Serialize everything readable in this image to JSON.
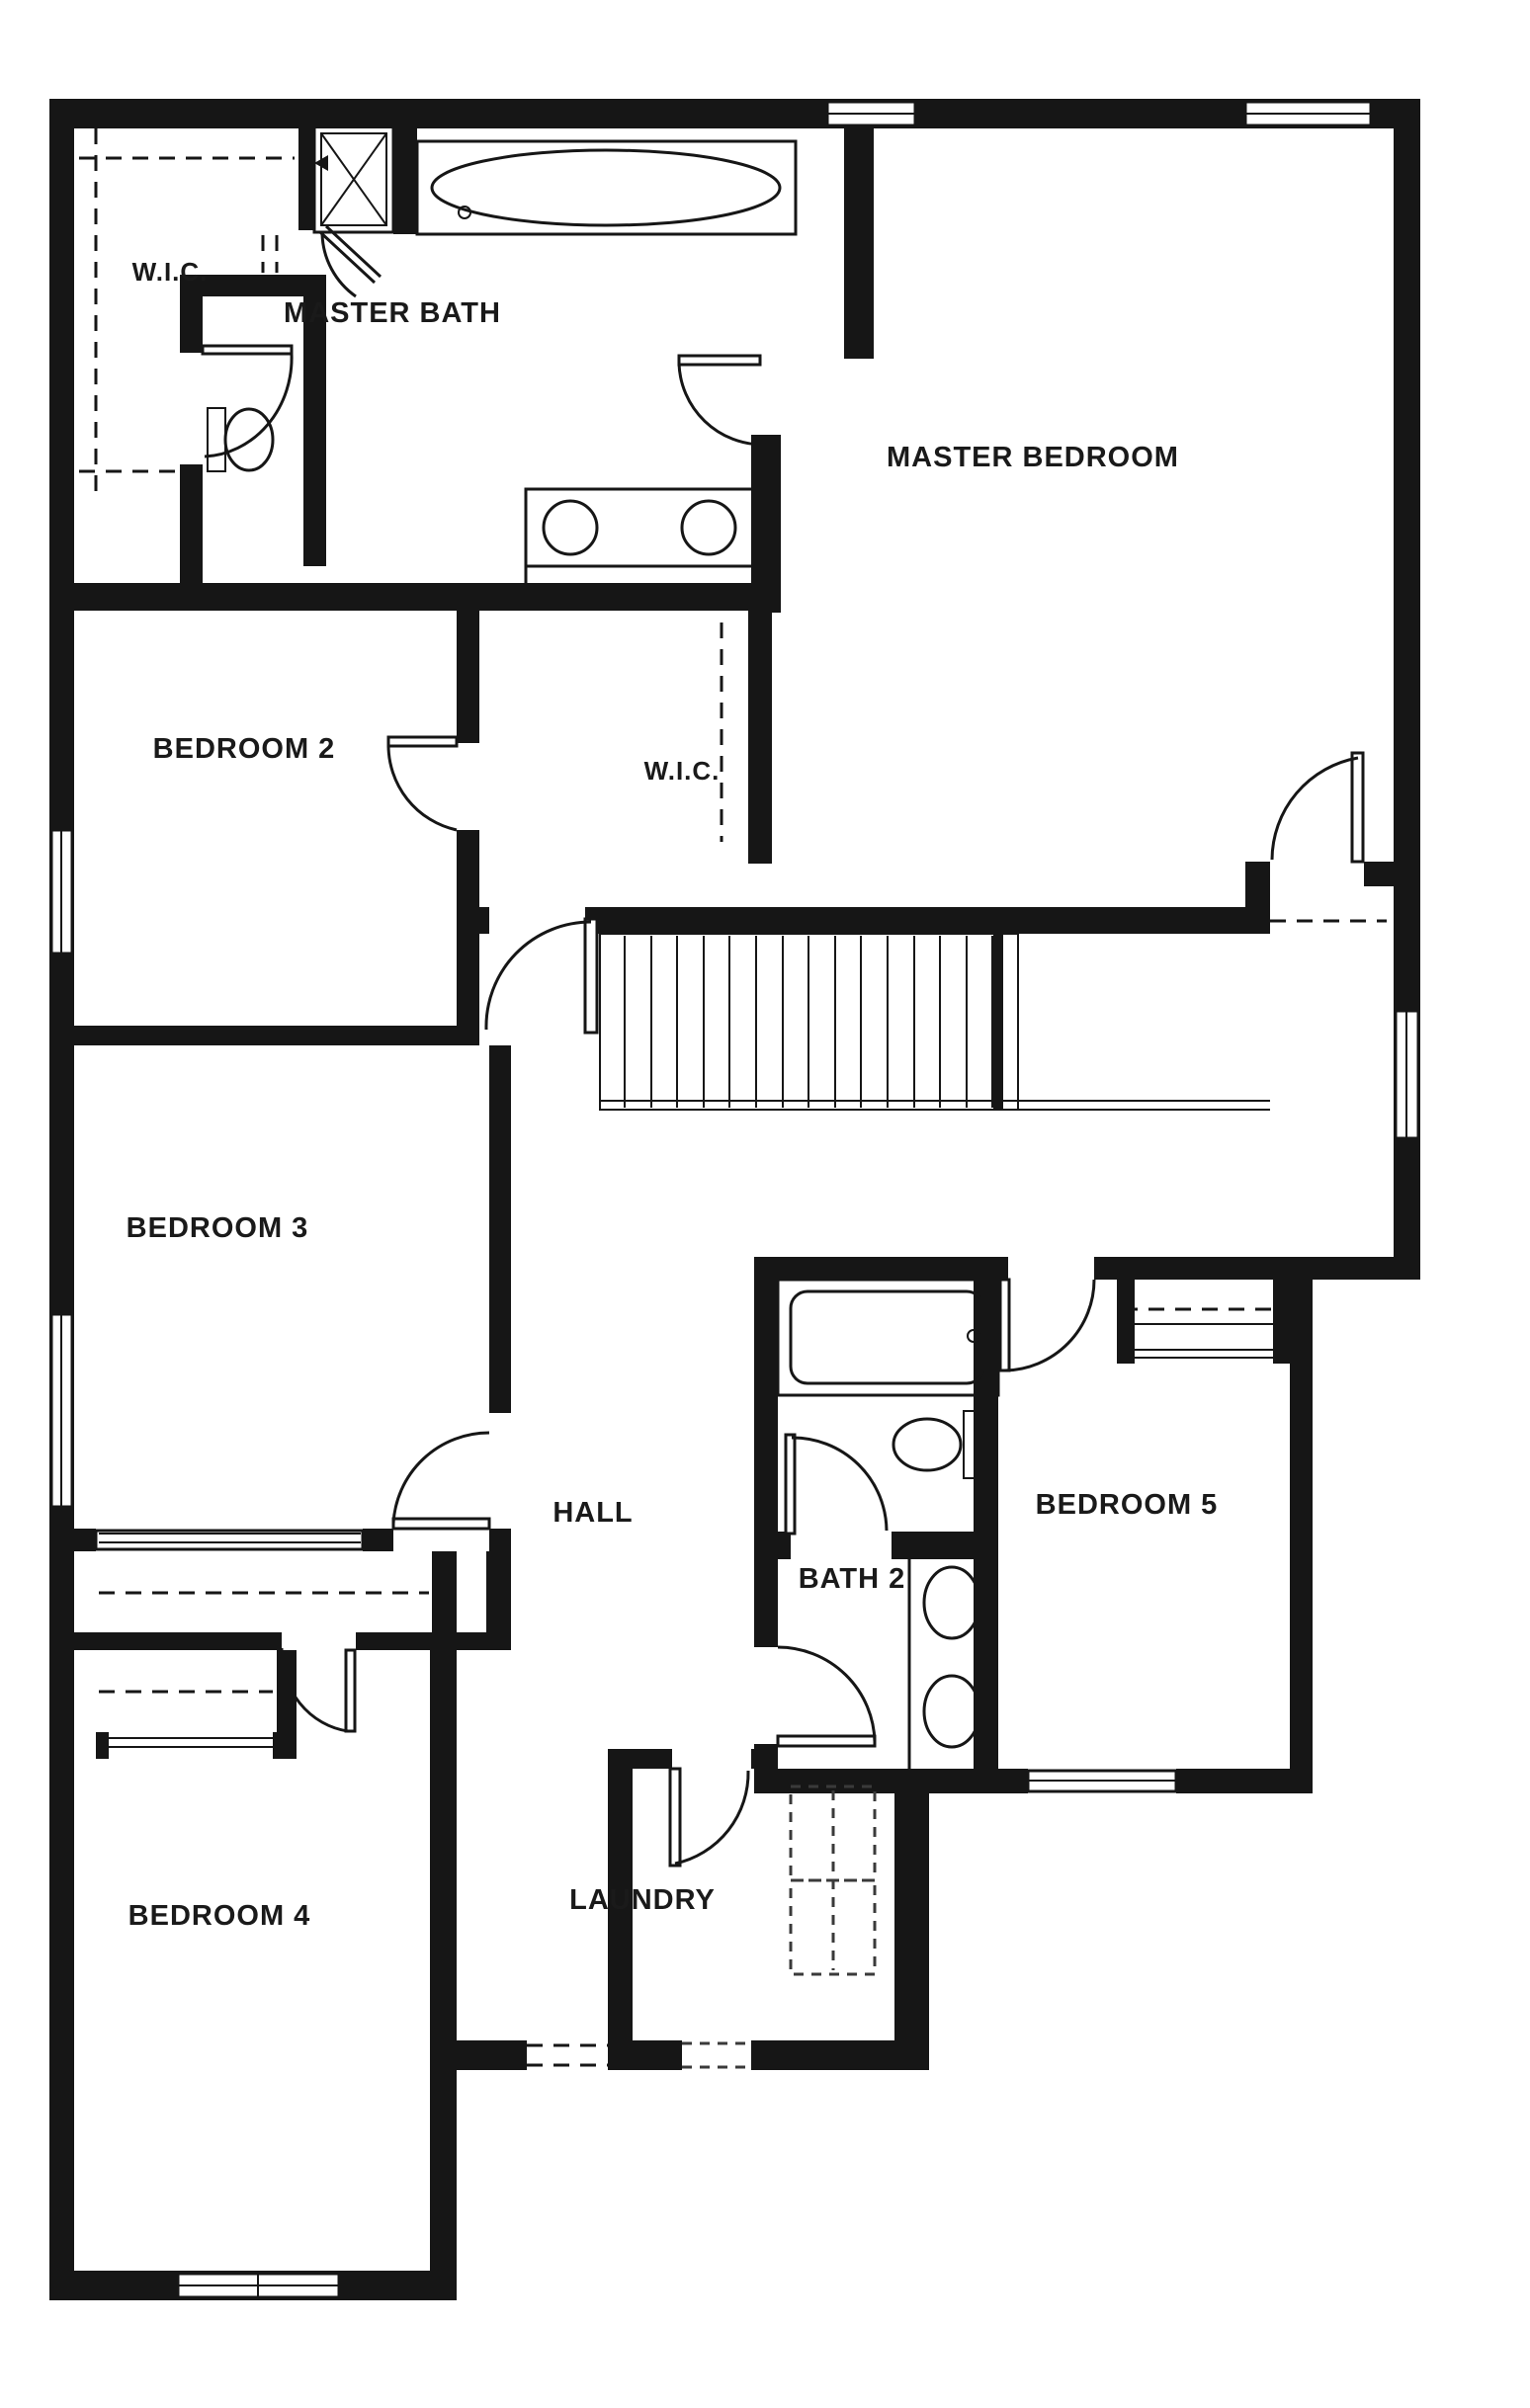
{
  "floor_plan": {
    "background_color": "#ffffff",
    "wall_color": "#161616",
    "text_color": "#1a1a1a",
    "rooms": [
      {
        "name": "wic-master",
        "label": "W.I.C."
      },
      {
        "name": "master-bath",
        "label": "MASTER BATH"
      },
      {
        "name": "master-bedroom",
        "label": "MASTER BEDROOM"
      },
      {
        "name": "bedroom-2",
        "label": "BEDROOM 2"
      },
      {
        "name": "wic-2",
        "label": "W.I.C."
      },
      {
        "name": "bedroom-3",
        "label": "BEDROOM 3"
      },
      {
        "name": "hall",
        "label": "HALL"
      },
      {
        "name": "bath-2",
        "label": "BATH 2"
      },
      {
        "name": "bedroom-5",
        "label": "BEDROOM 5"
      },
      {
        "name": "bedroom-4",
        "label": "BEDROOM 4"
      },
      {
        "name": "laundry",
        "label": "LAUNDRY"
      }
    ],
    "fixtures": [
      "shower-icon",
      "garden-tub-icon",
      "toilet-icon",
      "double-vanity-icon",
      "bathtub-icon",
      "toilet-icon",
      "double-vanity-icon",
      "washer-dryer-icon",
      "staircase-icon"
    ]
  }
}
